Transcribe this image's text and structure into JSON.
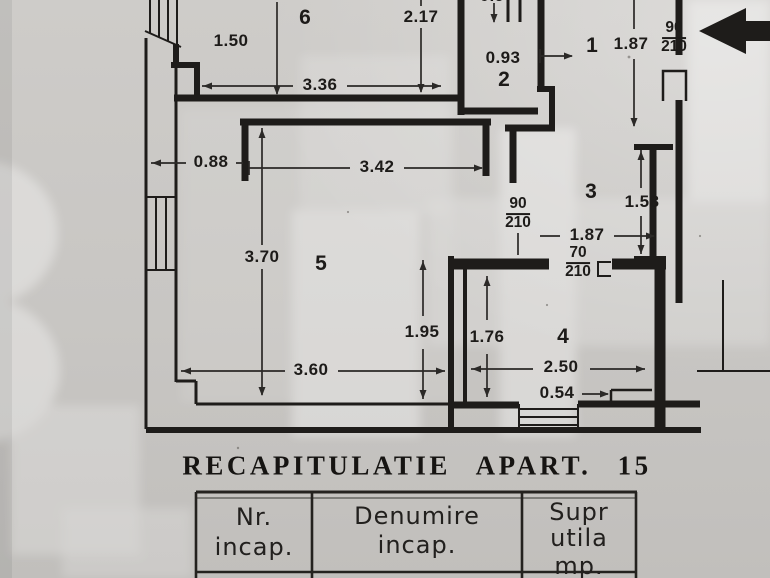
{
  "document": {
    "kind": "scanned apartment floor plan",
    "title": "RECAPITULATIE APART. 15",
    "table": {
      "columns": [
        {
          "name": "nr-incap",
          "lines": [
            "Nr.",
            "incap."
          ]
        },
        {
          "name": "denumire-incap",
          "lines": [
            "Denumire",
            "incap."
          ]
        },
        {
          "name": "supr-utila-mp",
          "lines": [
            "Supr",
            "utila",
            "mp."
          ]
        }
      ]
    }
  },
  "plan": {
    "room_numbers": [
      {
        "text": "1",
        "x": 592,
        "y": 46
      },
      {
        "text": "2",
        "x": 504,
        "y": 80
      },
      {
        "text": "3",
        "x": 591,
        "y": 192
      },
      {
        "text": "4",
        "x": 563,
        "y": 337
      },
      {
        "text": "5",
        "x": 321,
        "y": 264
      },
      {
        "text": "6",
        "x": 305,
        "y": 18
      }
    ],
    "dimensions": [
      {
        "text": "1.50",
        "x": 231,
        "y": 41
      },
      {
        "text": "2.17",
        "x": 421,
        "y": 17
      },
      {
        "text": "3.36",
        "x": 320,
        "y": 85
      },
      {
        "text": "0.93",
        "x": 503,
        "y": 58
      },
      {
        "text": "1.87",
        "x": 631,
        "y": 44
      },
      {
        "text": "0.88",
        "x": 211,
        "y": 162
      },
      {
        "text": "3.42",
        "x": 377,
        "y": 167
      },
      {
        "text": "1.58",
        "x": 642,
        "y": 202
      },
      {
        "text": "1.87",
        "x": 587,
        "y": 235
      },
      {
        "text": "3.70",
        "x": 262,
        "y": 257
      },
      {
        "text": "1.95",
        "x": 422,
        "y": 332
      },
      {
        "text": "1.76",
        "x": 487,
        "y": 337
      },
      {
        "text": "3.60",
        "x": 311,
        "y": 370
      },
      {
        "text": "2.50",
        "x": 561,
        "y": 367
      },
      {
        "text": "0.54",
        "x": 557,
        "y": 393
      }
    ],
    "door_sizes": [
      {
        "num": "90",
        "den": "210",
        "x": 674,
        "y": 38
      },
      {
        "num": "90",
        "den": "210",
        "x": 518,
        "y": 214
      },
      {
        "num": "70",
        "den": "210",
        "x": 578,
        "y": 263
      }
    ],
    "clipped_labels": [
      {
        "text": "0.97",
        "x": 497,
        "y": -4
      },
      {
        "text": "1.87",
        "x": 603,
        "y": -5
      }
    ]
  },
  "colors": {
    "paper": "#c8c6c3",
    "ink": "#1e1c1a"
  }
}
